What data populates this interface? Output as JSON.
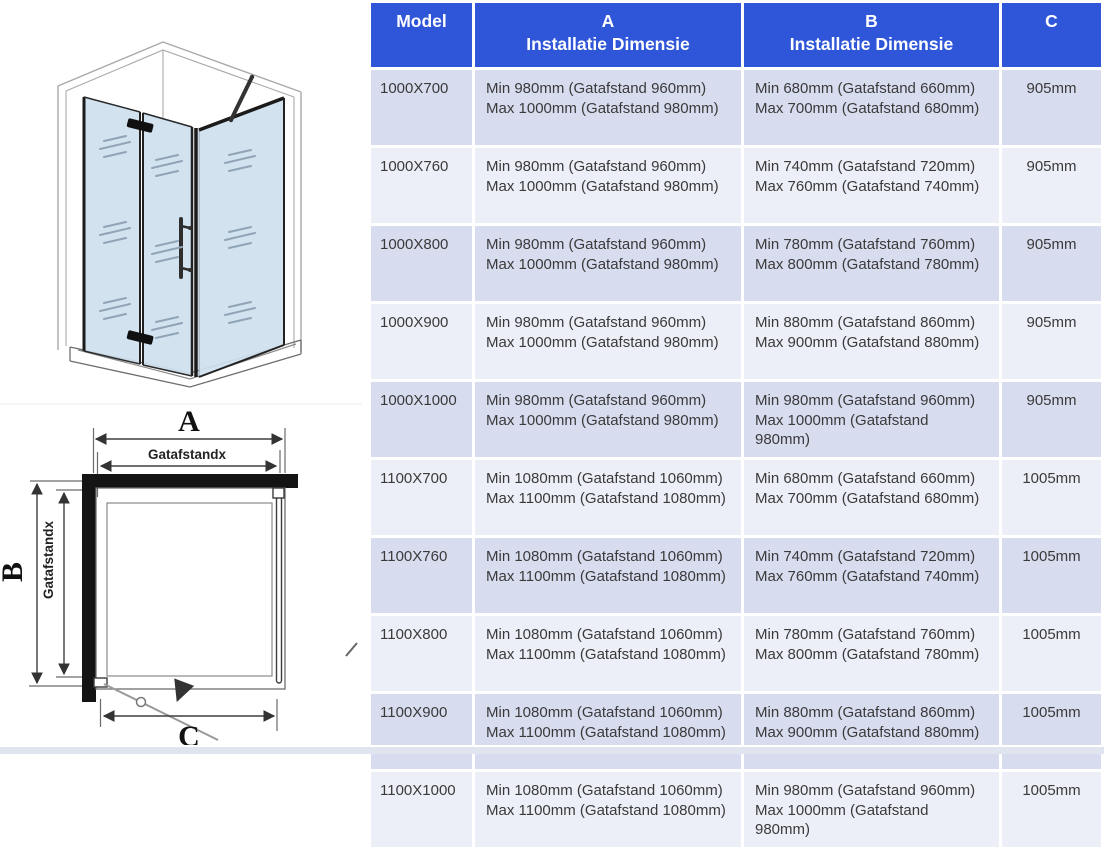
{
  "colors": {
    "header_bg": "#2f56d8",
    "header_text": "#ffffff",
    "row_odd": "#d8dcef",
    "row_even": "#edeff8",
    "body_text": "#3a3a3a",
    "gap": "#ffffff",
    "glass": "#cfe0ee",
    "wall_outline": "#a9a9a9",
    "plan_line": "#3f3f3f",
    "footer_strip": "#e0e4ee"
  },
  "diagram": {
    "label_a": "A",
    "label_b": "B",
    "label_c": "C",
    "gap_label_horizontal": "Gatafstandx",
    "gap_label_vertical": "Gatafstandx"
  },
  "table": {
    "headers": {
      "model": "Model",
      "a_top": "A",
      "a_sub": "Installatie Dimensie",
      "b_top": "B",
      "b_sub": "Installatie Dimensie",
      "c": "C"
    },
    "rows": [
      {
        "model": "1000X700",
        "a": [
          "Min 980mm (Gatafstand 960mm)",
          "Max 1000mm (Gatafstand 980mm)"
        ],
        "b": [
          "Min 680mm (Gatafstand 660mm)",
          "Max 700mm (Gatafstand 680mm)"
        ],
        "c": "905mm"
      },
      {
        "model": "1000X760",
        "a": [
          "Min 980mm (Gatafstand 960mm)",
          "Max 1000mm (Gatafstand 980mm)"
        ],
        "b": [
          "Min 740mm (Gatafstand 720mm)",
          "Max 760mm (Gatafstand 740mm)"
        ],
        "c": "905mm"
      },
      {
        "model": "1000X800",
        "a": [
          "Min 980mm (Gatafstand 960mm)",
          "Max 1000mm (Gatafstand 980mm)"
        ],
        "b": [
          "Min 780mm (Gatafstand 760mm)",
          "Max 800mm (Gatafstand 780mm)"
        ],
        "c": "905mm"
      },
      {
        "model": "1000X900",
        "a": [
          "Min 980mm (Gatafstand 960mm)",
          "Max 1000mm (Gatafstand 980mm)"
        ],
        "b": [
          "Min 880mm (Gatafstand 860mm)",
          "Max 900mm (Gatafstand 880mm)"
        ],
        "c": "905mm"
      },
      {
        "model": "1000X1000",
        "a": [
          "Min 980mm (Gatafstand 960mm)",
          "Max 1000mm (Gatafstand 980mm)"
        ],
        "b": [
          "Min 980mm (Gatafstand 960mm)",
          "Max 1000mm (Gatafstand",
          "980mm)"
        ],
        "c": "905mm"
      },
      {
        "model": "1100X700",
        "a": [
          "Min 1080mm (Gatafstand 1060mm)",
          "Max 1100mm (Gatafstand 1080mm)"
        ],
        "b": [
          "Min 680mm (Gatafstand 660mm)",
          "Max 700mm (Gatafstand 680mm)"
        ],
        "c": "1005mm"
      },
      {
        "model": "1100X760",
        "a": [
          "Min 1080mm (Gatafstand 1060mm)",
          "Max 1100mm (Gatafstand 1080mm)"
        ],
        "b": [
          "Min 740mm (Gatafstand 720mm)",
          "Max 760mm (Gatafstand 740mm)"
        ],
        "c": "1005mm"
      },
      {
        "model": "1100X800",
        "a": [
          "Min 1080mm (Gatafstand 1060mm)",
          "Max 1100mm (Gatafstand 1080mm)"
        ],
        "b": [
          "Min 780mm (Gatafstand 760mm)",
          "Max 800mm (Gatafstand 780mm)"
        ],
        "c": "1005mm"
      },
      {
        "model": "1100X900",
        "a": [
          "Min 1080mm (Gatafstand 1060mm)",
          "Max 1100mm (Gatafstand 1080mm)"
        ],
        "b": [
          "Min 880mm (Gatafstand 860mm)",
          "Max 900mm (Gatafstand 880mm)"
        ],
        "c": "1005mm"
      },
      {
        "model": "1100X1000",
        "a": [
          "Min 1080mm (Gatafstand 1060mm)",
          "Max 1100mm (Gatafstand 1080mm)"
        ],
        "b": [
          "Min 980mm (Gatafstand 960mm)",
          "Max 1000mm (Gatafstand",
          "980mm)"
        ],
        "c": "1005mm"
      }
    ]
  }
}
